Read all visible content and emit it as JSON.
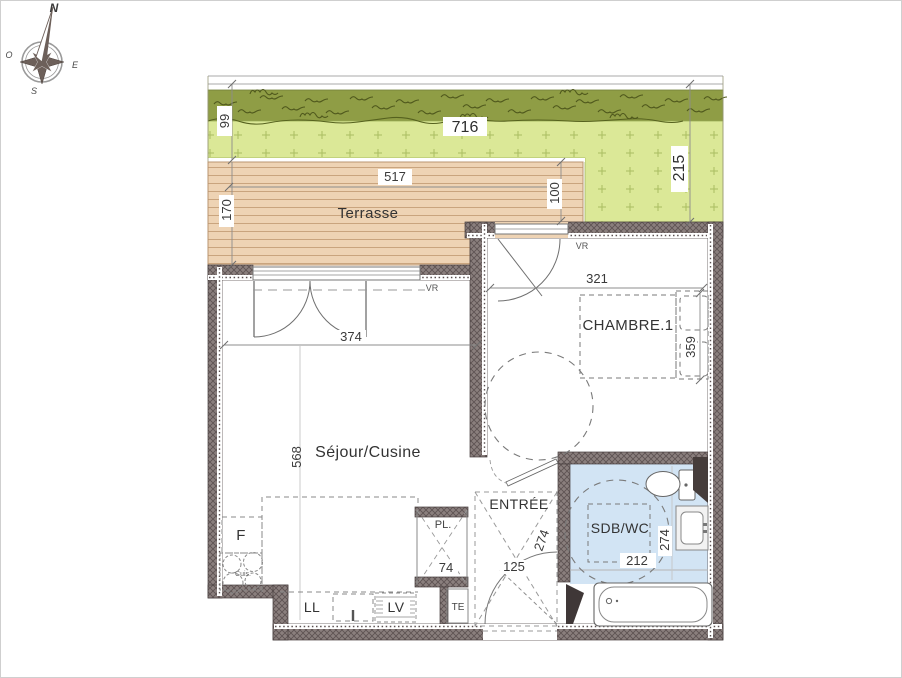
{
  "plan": {
    "compass": {
      "north": "N",
      "west": "O",
      "east": "E",
      "south": "S"
    },
    "garden": {
      "width": "716",
      "depth_left": "99",
      "depth_right": "215"
    },
    "terrace": {
      "name": "Terrasse",
      "width": "517",
      "depth_left": "170",
      "depth_right": "100"
    },
    "living": {
      "name": "Séjour/Cusine",
      "width": "374",
      "depth": "568"
    },
    "bedroom": {
      "name": "CHAMBRE.1",
      "width": "321",
      "bed_depth": "359"
    },
    "entry": {
      "name": "ENTRÉE",
      "clear_diag": "274",
      "width": "125"
    },
    "bathroom": {
      "name": "SDB/WC",
      "depth": "274",
      "width": "212"
    },
    "closet": {
      "name": "PL.",
      "width": "74"
    },
    "electrical_board": {
      "name": "TE"
    },
    "kitchen": {
      "fridge": "F",
      "hob": "Cuis.",
      "washing_machine": "LL",
      "dishwasher": "LV"
    },
    "shutter": {
      "label": "VR"
    },
    "colors": {
      "wall": "#8a7f7d",
      "terrace_deck": "#eed3b4",
      "lawn_dark": "#8f9d45",
      "lawn_light": "#dbe897",
      "bathroom_floor": "#d2e4f4"
    }
  }
}
